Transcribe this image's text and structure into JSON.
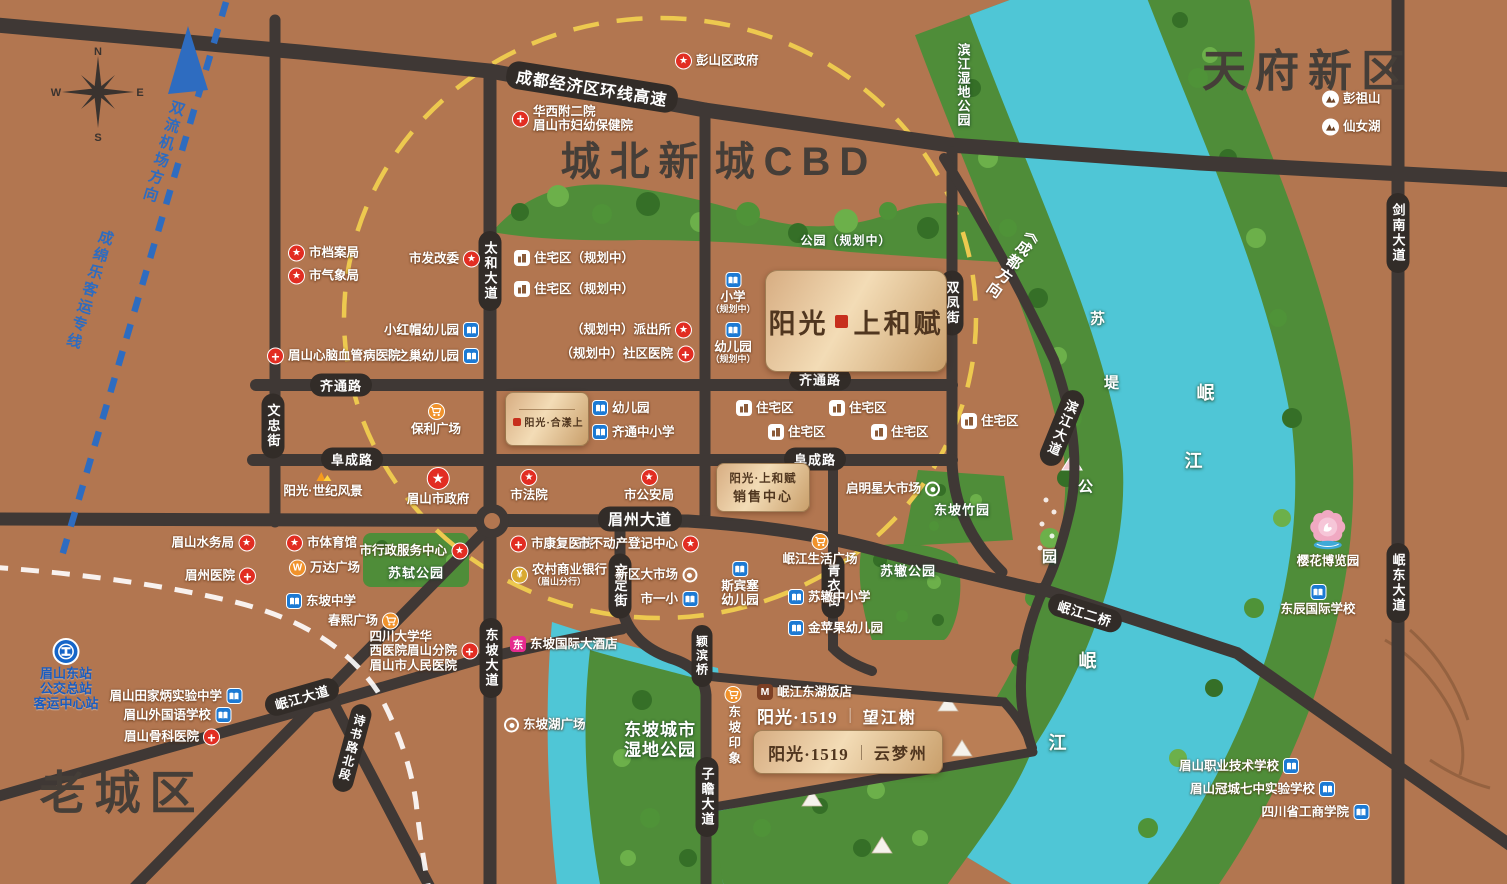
{
  "title": "阳光·上和赋 区位图",
  "colors": {
    "land": "#b27650",
    "river": "#4fc6d6",
    "green": "#4f8d39",
    "road": "#3f3835",
    "ring": "#edc94f",
    "rail": "#2e6cc0",
    "accent_red": "#e22d22",
    "accent_blue": "#1c7ad4",
    "accent_orange": "#f0922b"
  },
  "compass": {
    "n": "N",
    "s": "S",
    "e": "E",
    "w": "W"
  },
  "regions": [
    {
      "t": "城北新",
      "x": 634,
      "y": 158,
      "sz": 40
    },
    {
      "t": "城CBD",
      "x": 796,
      "y": 158,
      "sz": 40
    },
    {
      "t": "天府新区",
      "x": 1308,
      "y": 67,
      "sz": 44
    },
    {
      "t": "老城区",
      "x": 122,
      "y": 790,
      "sz": 46
    }
  ],
  "corridors": [
    {
      "t": "双流机场方向",
      "x": 163,
      "y": 152,
      "rot": 17
    },
    {
      "t": "成绵乐客运专线",
      "x": 89,
      "y": 290,
      "rot": 17
    }
  ],
  "road_labels": [
    {
      "t": "成都经济区环线高速",
      "x": 592,
      "y": 87,
      "rot": 9,
      "sz": 16,
      "cls": "cap"
    },
    {
      "t": "齐通路",
      "x": 341,
      "y": 385,
      "cls": "cap"
    },
    {
      "t": "齐通路",
      "x": 820,
      "y": 379,
      "cls": "cap"
    },
    {
      "t": "阜成路",
      "x": 352,
      "y": 459,
      "cls": "cap"
    },
    {
      "t": "阜成路",
      "x": 815,
      "y": 459,
      "cls": "cap"
    },
    {
      "t": "眉州大道",
      "x": 640,
      "y": 519,
      "sz": 15,
      "cls": "cap"
    },
    {
      "t": "太和大道",
      "x": 490,
      "y": 271,
      "v": 1,
      "cls": "cap"
    },
    {
      "t": "东坡大道",
      "x": 491,
      "y": 658,
      "v": 1,
      "cls": "cap"
    },
    {
      "t": "文忠街",
      "x": 273,
      "y": 426,
      "v": 1,
      "cls": "cap"
    },
    {
      "t": "双凤街",
      "x": 952,
      "y": 303,
      "v": 1,
      "cls": "cap"
    },
    {
      "t": "文定街",
      "x": 620,
      "y": 586,
      "v": 1,
      "cls": "cap"
    },
    {
      "t": "青衣街",
      "x": 833,
      "y": 586,
      "v": 1,
      "cls": "cap"
    },
    {
      "t": "颖滨桥",
      "x": 702,
      "y": 656,
      "v": 1,
      "sz": 12,
      "cls": "cap"
    },
    {
      "t": "子瞻大道",
      "x": 707,
      "y": 797,
      "v": 1,
      "cls": "cap"
    },
    {
      "t": "剑南大道",
      "x": 1398,
      "y": 233,
      "v": 1,
      "cls": "cap"
    },
    {
      "t": "岷东大道",
      "x": 1398,
      "y": 583,
      "v": 1,
      "cls": "cap"
    },
    {
      "t": "岷江大道",
      "x": 302,
      "y": 697,
      "rot": -16,
      "cls": "cap"
    },
    {
      "t": "诗书路北段",
      "x": 352,
      "y": 748,
      "v": 1,
      "rot": 15,
      "sz": 12,
      "cls": "cap"
    },
    {
      "t": "岷江二桥",
      "x": 1085,
      "y": 613,
      "rot": 17,
      "cls": "cap"
    },
    {
      "t": "滨江大道",
      "x": 1062,
      "y": 428,
      "v": 1,
      "rot": 22,
      "cls": "cap"
    },
    {
      "t": "《成都方向",
      "x": 1013,
      "y": 262,
      "v": 1,
      "rot": 35,
      "sz": 15,
      "cls": "plain"
    },
    {
      "t": "滨江湿地公园",
      "x": 963,
      "y": 85,
      "v": 1,
      "sz": 13,
      "cls": "wt"
    },
    {
      "t": "苏",
      "x": 1098,
      "y": 318,
      "sz": 15,
      "cls": "wt"
    },
    {
      "t": "堤",
      "x": 1112,
      "y": 382,
      "sz": 15,
      "cls": "wt"
    },
    {
      "t": "公",
      "x": 1086,
      "y": 486,
      "sz": 15,
      "cls": "wt"
    },
    {
      "t": "园",
      "x": 1050,
      "y": 556,
      "sz": 15,
      "cls": "wt"
    },
    {
      "t": "岷",
      "x": 1206,
      "y": 392,
      "sz": 18,
      "cls": "wt"
    },
    {
      "t": "江",
      "x": 1194,
      "y": 460,
      "sz": 18,
      "cls": "wt"
    },
    {
      "t": "岷",
      "x": 1088,
      "y": 660,
      "sz": 18,
      "cls": "wt"
    },
    {
      "t": "江",
      "x": 1058,
      "y": 742,
      "sz": 18,
      "cls": "wt"
    },
    {
      "t": "苏轼公园",
      "x": 416,
      "y": 572,
      "sz": 13,
      "cls": "wt"
    },
    {
      "t": "苏辙公园",
      "x": 908,
      "y": 570,
      "sz": 13,
      "cls": "wt"
    },
    {
      "t": "东坡竹园",
      "x": 962,
      "y": 509,
      "sz": 13,
      "cls": "wt"
    },
    {
      "t": "公园（规划中）",
      "x": 846,
      "y": 240,
      "sz": 12,
      "cls": "wt"
    },
    {
      "t": "东坡城市",
      "x": 660,
      "y": 728,
      "sz": 17,
      "cls": "wt"
    },
    {
      "t": "湿地公园",
      "x": 660,
      "y": 748,
      "sz": 17,
      "cls": "wt"
    }
  ],
  "pois": [
    {
      "l": "彭山区政府",
      "i": "star",
      "x": 684,
      "y": 61,
      "s": "L"
    },
    {
      "lines": [
        "华西附二院",
        "眉山市妇幼保健院"
      ],
      "i": "hospital",
      "x": 521,
      "y": 119,
      "s": "L",
      "align": "left"
    },
    {
      "l": "彭祖山",
      "i": "mtn",
      "x": 1331,
      "y": 99,
      "s": "L"
    },
    {
      "l": "仙女湖",
      "i": "mtn",
      "x": 1331,
      "y": 127,
      "s": "L"
    },
    {
      "l": "市档案局",
      "i": "star",
      "x": 297,
      "y": 253,
      "s": "L"
    },
    {
      "l": "市气象局",
      "i": "star",
      "x": 297,
      "y": 276,
      "s": "L"
    },
    {
      "l": "市发改委",
      "i": "star",
      "x": 471,
      "y": 259,
      "s": "R"
    },
    {
      "l": "住宅区（规划中）",
      "i": "res",
      "x": 523,
      "y": 258,
      "s": "L"
    },
    {
      "l": "住宅区（规划中）",
      "i": "res",
      "x": 523,
      "y": 289,
      "s": "L"
    },
    {
      "l": "小红帽幼儿园",
      "i": "sch",
      "x": 470,
      "y": 330,
      "s": "R"
    },
    {
      "l": "乌之巢幼儿园",
      "i": "sch",
      "x": 470,
      "y": 356,
      "s": "R"
    },
    {
      "l": "眉山心脑血管病医院",
      "i": "hospital",
      "x": 276,
      "y": 356,
      "s": "L"
    },
    {
      "l": "（规划中）派出所",
      "i": "star",
      "x": 683,
      "y": 330,
      "s": "R"
    },
    {
      "l": "（规划中）社区医院",
      "i": "hospital",
      "x": 685,
      "y": 354,
      "s": "R"
    },
    {
      "lines": [
        "小学",
        "（规划中）"
      ],
      "i": "sch",
      "x": 733,
      "y": 281,
      "s": "A"
    },
    {
      "lines": [
        "幼儿园",
        "（规划中）"
      ],
      "i": "sch",
      "x": 733,
      "y": 331,
      "s": "A"
    },
    {
      "l": "保利广场",
      "i": "cart",
      "x": 436,
      "y": 412,
      "s": "A"
    },
    {
      "l": "幼儿园",
      "i": "sch",
      "x": 601,
      "y": 408,
      "s": "L"
    },
    {
      "l": "齐通中小学",
      "i": "sch",
      "x": 601,
      "y": 432,
      "s": "L"
    },
    {
      "l": "住宅区",
      "i": "res",
      "x": 745,
      "y": 408,
      "s": "L"
    },
    {
      "l": "住宅区",
      "i": "res",
      "x": 838,
      "y": 408,
      "s": "L"
    },
    {
      "l": "住宅区",
      "i": "res",
      "x": 777,
      "y": 432,
      "s": "L"
    },
    {
      "l": "住宅区",
      "i": "res",
      "x": 880,
      "y": 432,
      "s": "L"
    },
    {
      "l": "住宅区",
      "i": "res",
      "x": 970,
      "y": 421,
      "s": "L"
    },
    {
      "l": "阳光·世纪风景",
      "i": "sun",
      "x": 323,
      "y": 479,
      "s": "A"
    },
    {
      "l": "眉山市政府",
      "i": "star",
      "x": 438,
      "y": 476,
      "s": "A",
      "big": 1
    },
    {
      "l": "市法院",
      "i": "star",
      "x": 529,
      "y": 478,
      "s": "A"
    },
    {
      "l": "市公安局",
      "i": "star",
      "x": 649,
      "y": 478,
      "s": "A"
    },
    {
      "l": "启明星大市场",
      "i": "tgt",
      "x": 931,
      "y": 489,
      "s": "R"
    },
    {
      "l": "市康复医院",
      "i": "hospital",
      "x": 519,
      "y": 544,
      "s": "L"
    },
    {
      "l": "市不动产登记中心",
      "i": "star",
      "x": 690,
      "y": 544,
      "s": "R"
    },
    {
      "lines": [
        "农村商业银行",
        "（眉山分行）"
      ],
      "i": "bank",
      "x": 520,
      "y": 575,
      "s": "L",
      "align": "left"
    },
    {
      "l": "新区大市场",
      "i": "tgt",
      "x": 688,
      "y": 575,
      "s": "R"
    },
    {
      "l": "市一小",
      "i": "sch",
      "x": 689,
      "y": 599,
      "s": "R"
    },
    {
      "lines": [
        "斯宾塞",
        "幼儿园"
      ],
      "i": "sch",
      "x": 740,
      "y": 570,
      "s": "A"
    },
    {
      "l": "岷江生活广场",
      "i": "cart",
      "x": 820,
      "y": 542,
      "s": "A"
    },
    {
      "l": "苏辙中小学",
      "i": "sch",
      "x": 797,
      "y": 597,
      "s": "L"
    },
    {
      "l": "金苹果幼儿园",
      "i": "sch",
      "x": 797,
      "y": 628,
      "s": "L"
    },
    {
      "l": "眉山水务局",
      "i": "star",
      "x": 246,
      "y": 543,
      "s": "R"
    },
    {
      "l": "市体育馆",
      "i": "star",
      "x": 295,
      "y": 543,
      "s": "L"
    },
    {
      "l": "市行政服务中心",
      "i": "star",
      "x": 459,
      "y": 551,
      "s": "R"
    },
    {
      "l": "万达广场",
      "i": "wanda",
      "x": 298,
      "y": 568,
      "s": "L"
    },
    {
      "l": "眉州医院",
      "i": "hospital",
      "x": 247,
      "y": 576,
      "s": "R"
    },
    {
      "l": "东坡中学",
      "i": "sch",
      "x": 295,
      "y": 601,
      "s": "L"
    },
    {
      "l": "春熙广场",
      "i": "cart",
      "x": 390,
      "y": 621,
      "s": "R"
    },
    {
      "l": "东坡国际大酒店",
      "i": "hotelpink",
      "x": 519,
      "y": 644,
      "s": "L"
    },
    {
      "lines": [
        "眉山东站",
        "公交总站",
        "客运中心站"
      ],
      "i": "train",
      "x": 66,
      "y": 652,
      "s": "A",
      "cls": "blue",
      "oy": 14
    },
    {
      "l": "眉山田家炳实验中学",
      "i": "sch",
      "x": 233,
      "y": 696,
      "s": "R"
    },
    {
      "l": "眉山外国语学校",
      "i": "sch",
      "x": 222,
      "y": 715,
      "s": "R"
    },
    {
      "l": "眉山骨科医院",
      "i": "hospital",
      "x": 211,
      "y": 737,
      "s": "R"
    },
    {
      "lines": [
        "四川大学华",
        "西医院眉山分院",
        "眉山市人民医院"
      ],
      "i": "hospital",
      "x": 469,
      "y": 651,
      "s": "R",
      "align": "left"
    },
    {
      "l": "东坡湖广场",
      "i": "tgt",
      "x": 513,
      "y": 725,
      "s": "L"
    },
    {
      "l": "岷江东湖饭店",
      "i": "hotelm",
      "x": 766,
      "y": 692,
      "s": "L"
    },
    {
      "l": "东坡印象",
      "i": "cart",
      "x": 733,
      "y": 695,
      "s": "A",
      "vert": 1
    },
    {
      "l": "樱花博览园",
      "i": "flower",
      "x": 1328,
      "y": 530,
      "s": "A",
      "oy": 20
    },
    {
      "l": "东辰国际学校",
      "i": "sch",
      "x": 1318,
      "y": 593,
      "s": "A"
    },
    {
      "l": "眉山职业技术学校",
      "i": "sch",
      "x": 1290,
      "y": 766,
      "s": "R"
    },
    {
      "l": "眉山冠城七中实验学校",
      "i": "sch",
      "x": 1326,
      "y": 789,
      "s": "R"
    },
    {
      "l": "四川省工商学院",
      "i": "sch",
      "x": 1360,
      "y": 812,
      "s": "R"
    }
  ],
  "plates": {
    "main": {
      "part1": "阳光",
      "part2": "上和赋"
    },
    "sales": {
      "line1": "阳光·上和赋",
      "line2": "销售中心"
    },
    "heyang": {
      "name": "阳光·合漾上"
    },
    "wangjiang": {
      "brand": "阳光·1519",
      "sep": "｜",
      "name": "望江榭"
    },
    "yunmeng": {
      "brand": "阳光·1519",
      "sep": "｜",
      "name": "云梦州"
    }
  }
}
